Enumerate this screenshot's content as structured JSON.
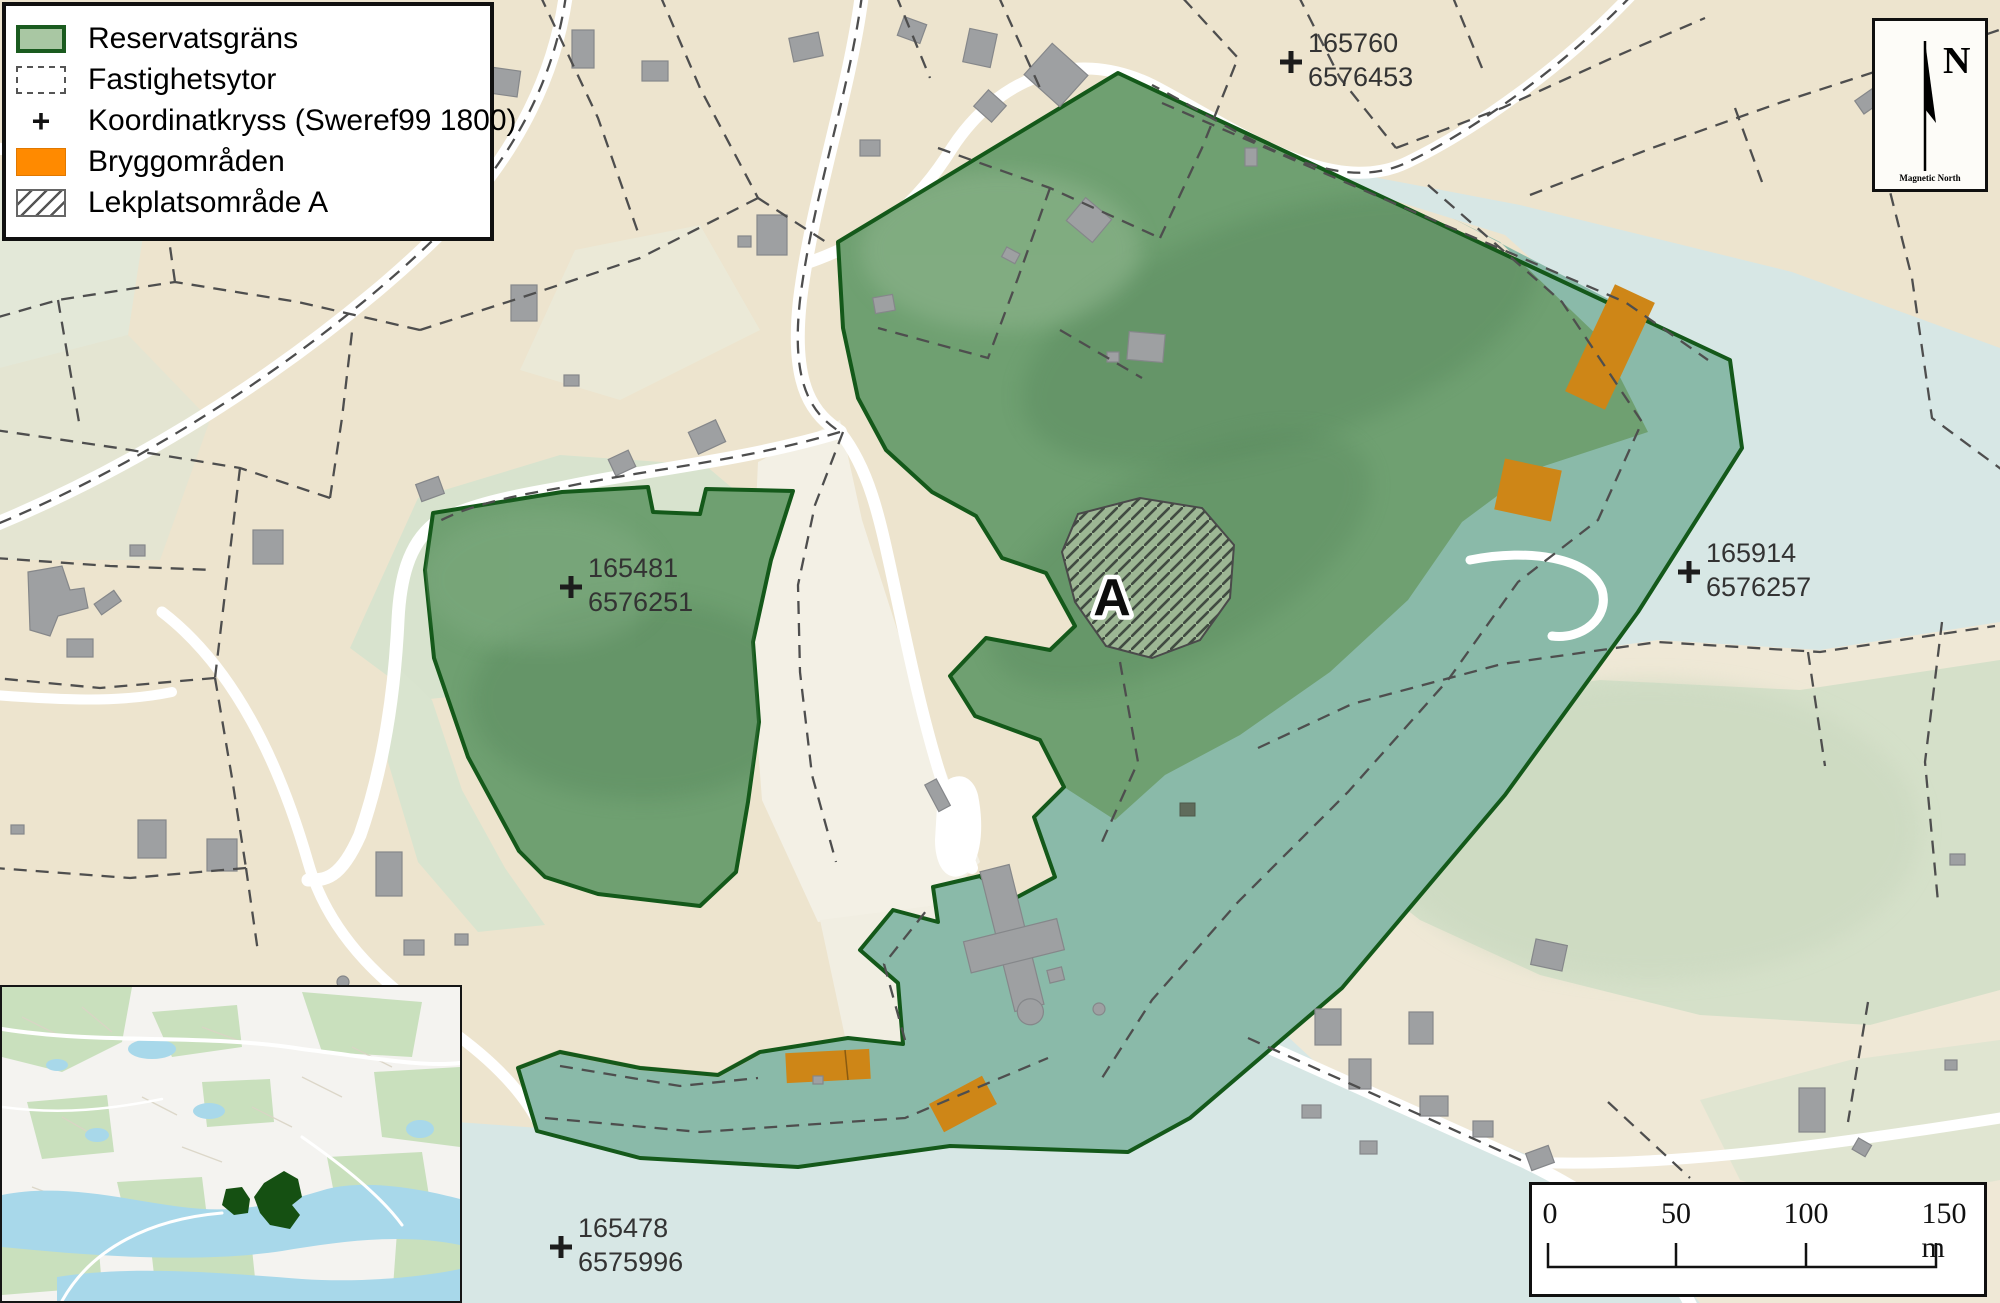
{
  "colors": {
    "land": "#EDE4CE",
    "field": "#F3F0E5",
    "vegetation": "#DBE4D0",
    "water": "#D7E7E5",
    "reserve_fill": "#6FA071",
    "reserve_water": "#8ABAA9",
    "reserve_border": "#14591A",
    "dock_map": "#CE8617",
    "dock_legend": "#FF8A00",
    "building": "#9EA0A2",
    "parcel_line": "#4E4E4E"
  },
  "legend": {
    "items": [
      {
        "label": "Reservatsgräns",
        "swatch": "reserve-boundary"
      },
      {
        "label": "Fastighetsytor",
        "swatch": "property-areas"
      },
      {
        "label": "Koordinatkryss (Sweref99 1800)",
        "swatch": "coordinate-cross",
        "symbol": "+"
      },
      {
        "label": "Bryggområden",
        "swatch": "dock-areas"
      },
      {
        "label": "Lekplatsområde A",
        "swatch": "playground-area"
      }
    ]
  },
  "north_box": {
    "letter": "N",
    "caption": "Magnetic North"
  },
  "scale_bar": {
    "labels": [
      "0",
      "50",
      "100",
      "150 m"
    ]
  },
  "area_label": "A",
  "coordinate_crosses": [
    {
      "easting": "165760",
      "northing": "6576453"
    },
    {
      "easting": "165481",
      "northing": "6576251"
    },
    {
      "easting": "165914",
      "northing": "6576257"
    },
    {
      "easting": "165478",
      "northing": "6575996"
    }
  ]
}
